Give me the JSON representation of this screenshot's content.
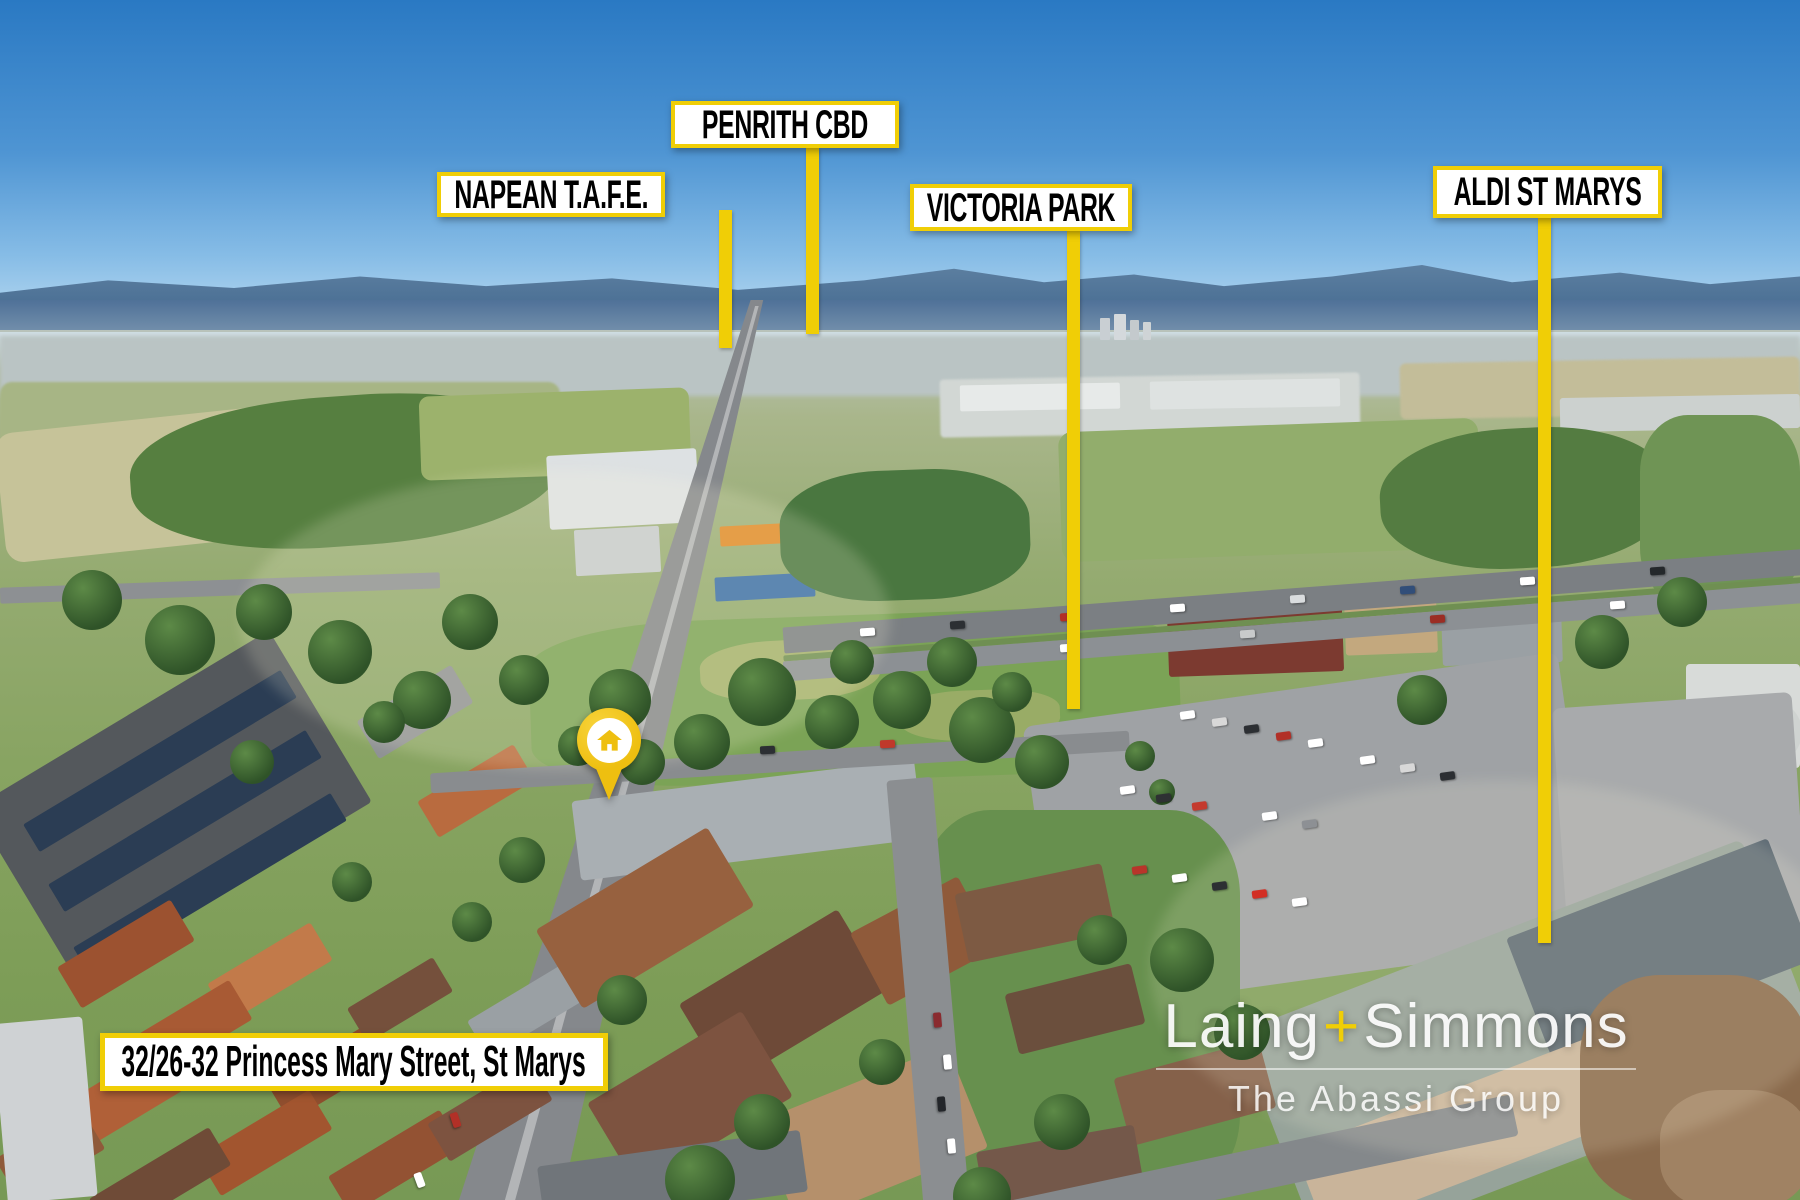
{
  "colors": {
    "annotation_yellow": "#F0CE06",
    "callout_bg": "#FFFFFF",
    "callout_text": "#000000",
    "pin_gold": "#EEBF10",
    "watermark_white": "#FFFFFF"
  },
  "callouts": [
    {
      "text": "PENRITH CBD"
    },
    {
      "text": "NAPEAN T.A.F.E."
    },
    {
      "text": "VICTORIA PARK"
    },
    {
      "text": "ALDI ST MARYS"
    }
  ],
  "address_banner": {
    "text": "32/26-32 Princess Mary Street, St Marys"
  },
  "watermark": {
    "brand_first": "Laing",
    "brand_plus": "+",
    "brand_second": "Simmons",
    "tagline": "The Abassi Group"
  }
}
